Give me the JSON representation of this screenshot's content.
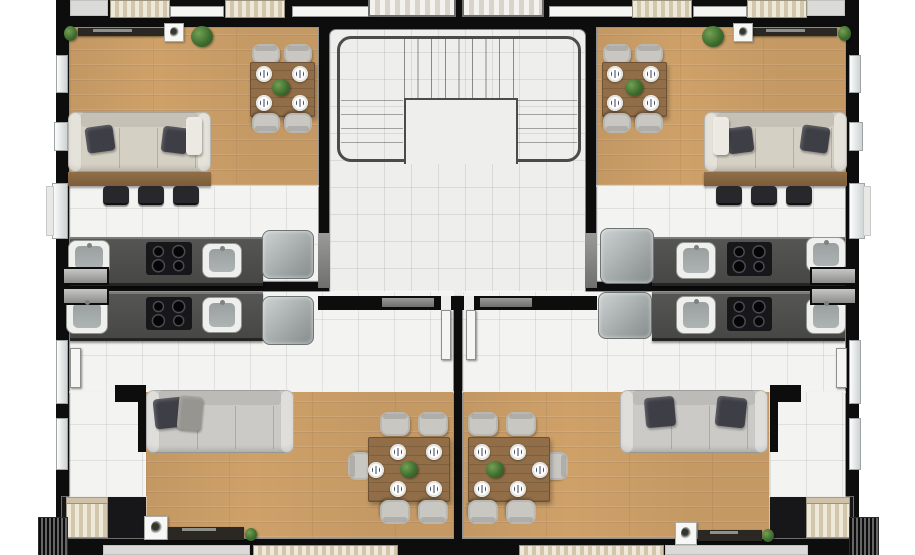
{
  "scene": {
    "kind": "apartment-building-floor-plan-render",
    "view": "top-down",
    "units_count": 4,
    "units": [
      {
        "id": "unit-top-left",
        "rooms": [
          "living-room",
          "dining-area",
          "kitchen"
        ],
        "furniture": [
          "sofa-3-seat-beige",
          "console-table",
          "bar-stool",
          "bar-stool",
          "bar-stool",
          "dining-table-4-seat",
          "tv-console",
          "potted-plant",
          "potted-plant",
          "kitchen-counter",
          "cooktop-4-burner",
          "sink",
          "sink",
          "fridge"
        ]
      },
      {
        "id": "unit-top-right",
        "rooms": [
          "living-room",
          "dining-area",
          "kitchen"
        ],
        "furniture": [
          "sofa-3-seat-beige",
          "console-table",
          "bar-stool",
          "bar-stool",
          "bar-stool",
          "dining-table-4-seat",
          "tv-console",
          "potted-plant",
          "potted-plant",
          "kitchen-counter",
          "cooktop-4-burner",
          "sink",
          "sink",
          "fridge"
        ]
      },
      {
        "id": "unit-bottom-left",
        "rooms": [
          "kitchen",
          "hallway",
          "living-room",
          "dining-area",
          "closet"
        ],
        "furniture": [
          "sofa-3-seat-gray",
          "dining-table-6-seat",
          "tv-console",
          "potted-plant",
          "kitchen-counter",
          "cooktop-4-burner",
          "sink",
          "sink",
          "fridge",
          "wardrobe"
        ]
      },
      {
        "id": "unit-bottom-right",
        "rooms": [
          "kitchen",
          "hallway",
          "living-room",
          "dining-area",
          "closet"
        ],
        "furniture": [
          "sofa-3-seat-gray",
          "dining-table-6-seat",
          "tv-console",
          "potted-plant",
          "kitchen-counter",
          "cooktop-4-burner",
          "sink",
          "sink",
          "fridge",
          "wardrobe"
        ]
      }
    ],
    "core": {
      "features": [
        "staircase",
        "railing",
        "landing",
        "tiled-floor"
      ],
      "stair_treads": 8,
      "side_step_rows": 4,
      "entry_doors": 2
    },
    "dining": {
      "top_tables_seats": 4,
      "top_tables_plates": 4,
      "bottom_tables_seats": 5,
      "bottom_tables_plates": 5
    },
    "openings": {
      "windows_left_wall": 5,
      "windows_right_wall": 5,
      "service_windows_per_side": 2,
      "top_edge_doors": 4,
      "core_bottom_doors": 2
    }
  },
  "colors": {
    "wall": "#0d0d0d",
    "wood_floor": "#cfa169",
    "tile_floor": "#f3f3f1",
    "core_tile": "#eeeeec",
    "counter": "#555553",
    "cooktop": "#17171a",
    "sink": "#eff0ee",
    "appliance": "#9aa0a0",
    "sofa_beige": "#d5d0c4",
    "sofa_gray": "#cbcac6",
    "pillow_dark": "#3e3e46",
    "chair": "#c8c7c2",
    "table_wood": "#916e48",
    "plant": "#3f6e2f",
    "railing": "#4b4b4b",
    "wardrobe_beige": "#e6dfcd",
    "door_white": "#f5f5f3",
    "window_glass": "#cdd2d3"
  }
}
